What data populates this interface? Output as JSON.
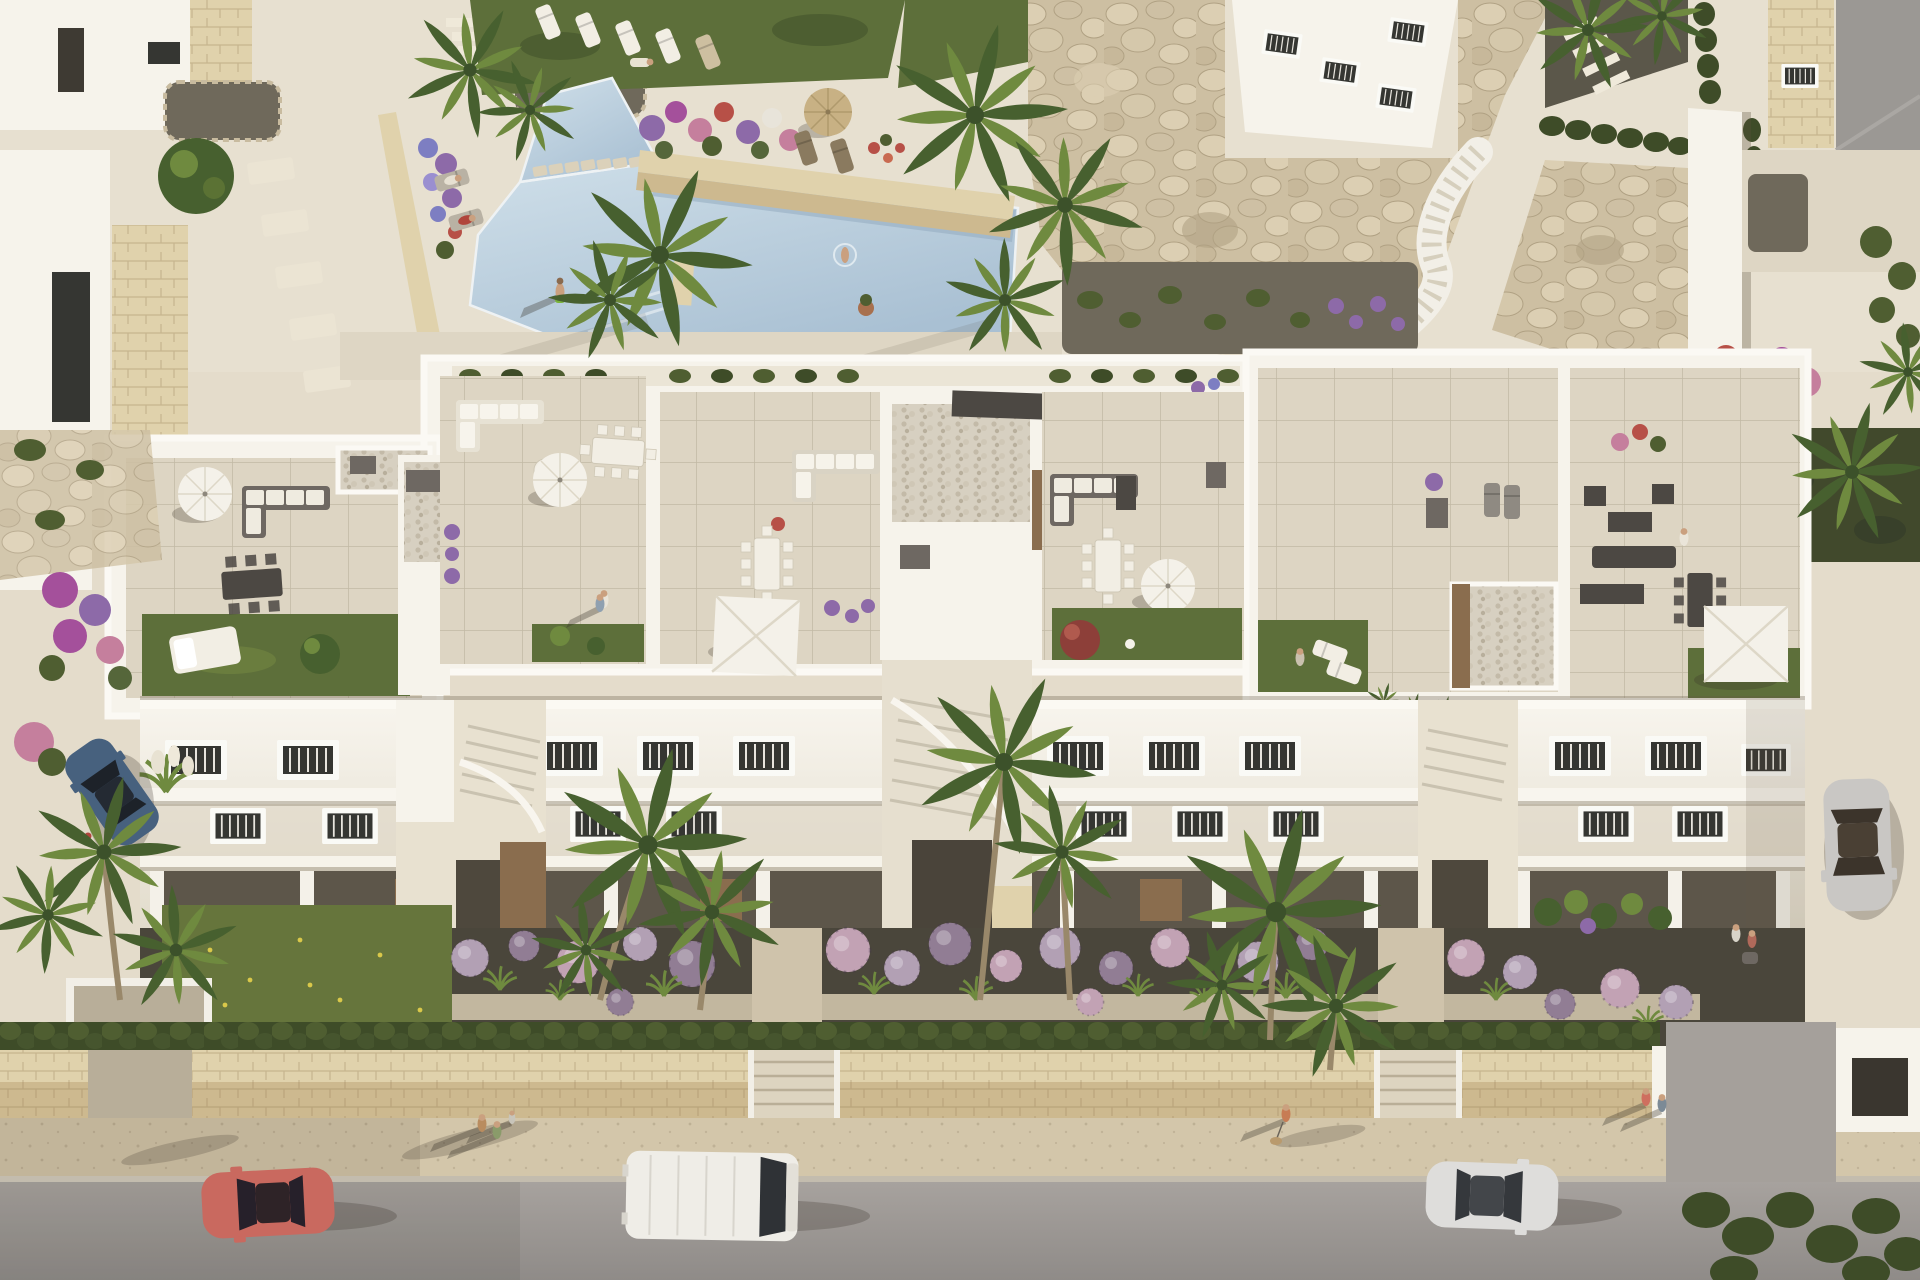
{
  "scene": {
    "description": "Aerial render of a modern white Mediterranean apartment block with furnished rooftop terraces, a communal swimming pool with stepping stones, boulder retaining walls, gardens of palms and round purple shrubs, and a street in front with a red coupe, a white van, a white sedan, parked cars and pedestrians.",
    "inventory": {
      "swimming_pools": 1,
      "rooftop_terraces": 6,
      "sun_umbrellas": 7,
      "cars_on_street": 3,
      "parked_cars": 2,
      "pedestrian_groups": 6
    },
    "palette": {
      "deck": "#e4dccb",
      "deck_top": "#e7e0d0",
      "path": "#ded6c4",
      "pool_light": "#cfdfe9",
      "pool_mid": "#a9c0d3",
      "pool_shadow": "#93abc0",
      "grass": "#5d6f3a",
      "grass_light": "#708340",
      "grass_wild": "#66753c",
      "rock_base": "#cdbfa2",
      "rock_hi": "#dccfb3",
      "rock_lo": "#b0a183",
      "white_wall": "#f6f3eb",
      "parapet": "#fbf9f4",
      "tile": "#ddd5c3",
      "pebble": "#d7d0c1",
      "soil": "#4a463b",
      "gravel": "#6f695b",
      "hedge": "#4f5e31",
      "hedge_dark": "#3e4c28",
      "pompom_a": "#b2a0b4",
      "pompom_b": "#917d94",
      "pompom_c": "#c2a2b4",
      "palm_dark": "#47602f",
      "palm_light": "#6f8a3f",
      "trunk": "#99886a",
      "flower_purple": "#8d6aa8",
      "flower_pink": "#c57f9d",
      "flower_red": "#b75047",
      "flower_magenta": "#a4509b",
      "wall_top": "#e0d2ac",
      "wall_face": "#cdb98f",
      "sidewalk": "#d3c6aa",
      "road": "#a7a29e",
      "road_dark": "#8f8b88",
      "furn_white": "#f2eee4",
      "furn_grey": "#6e6862",
      "furn_dark": "#4c4843",
      "glass": "#353632",
      "shutter": "#e8e5de",
      "car_red": "#c9695f",
      "car_blue": "#47617e",
      "car_silver": "#c9c7c4",
      "van_white": "#efede7",
      "sedan_white": "#dedddb",
      "umbrella": "#f4f1e9",
      "straw": "#c8b184",
      "skin": "#caa07f",
      "terracotta": "#a8704e",
      "wood": "#8a6d4e"
    }
  }
}
